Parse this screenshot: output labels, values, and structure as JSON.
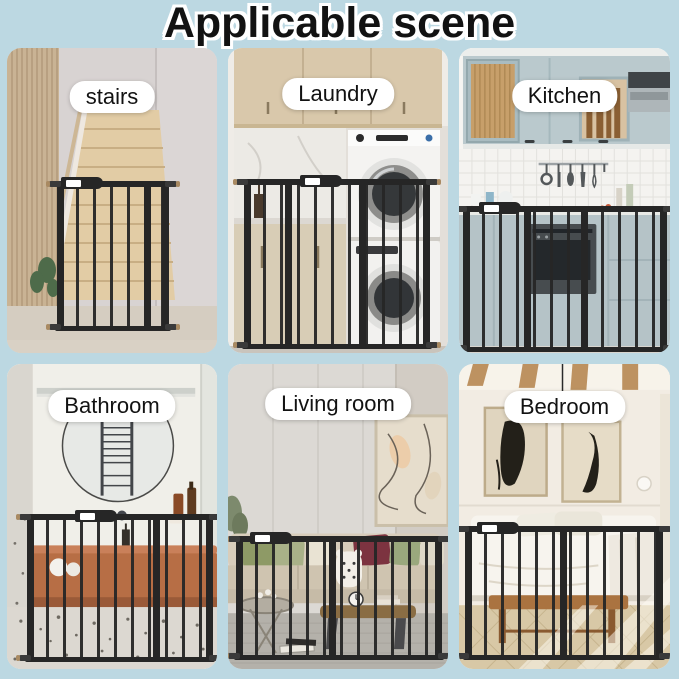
{
  "title": "Applicable scene",
  "colors": {
    "background": "#bcd8e2",
    "title_text": "#121212",
    "title_outline": "#ffffff",
    "label_background": "#ffffff",
    "label_text": "#121212",
    "gate": "#262626"
  },
  "panels": [
    {
      "id": "stairs",
      "label": "stairs"
    },
    {
      "id": "laundry",
      "label": "Laundry"
    },
    {
      "id": "kitchen",
      "label": "Kitchen"
    },
    {
      "id": "bathroom",
      "label": "Bathroom"
    },
    {
      "id": "living-room",
      "label": "Living room"
    },
    {
      "id": "bedroom",
      "label": "Bedroom"
    }
  ]
}
